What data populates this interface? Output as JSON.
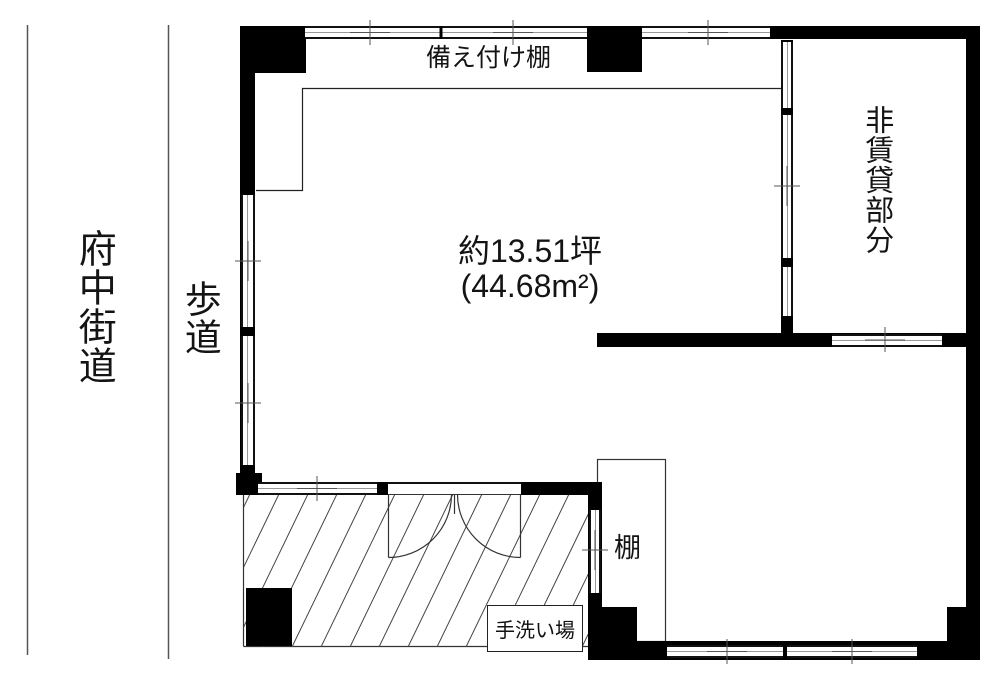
{
  "street": {
    "road": "府中街道",
    "sidewalk": "歩道"
  },
  "labels": {
    "built_in_shelf": "備え付け棚",
    "area_line1": "約13.51坪",
    "area_line2": "(44.68m²)",
    "non_rental": "非賃貸部分",
    "shelf": "棚",
    "hand_wash": "手洗い場"
  },
  "measurements": {
    "area_tsubo": 13.51,
    "area_sqm": 44.68
  },
  "colors": {
    "wall": "#000000",
    "line": "#333333",
    "window_center": "#999999",
    "background": "#ffffff"
  }
}
